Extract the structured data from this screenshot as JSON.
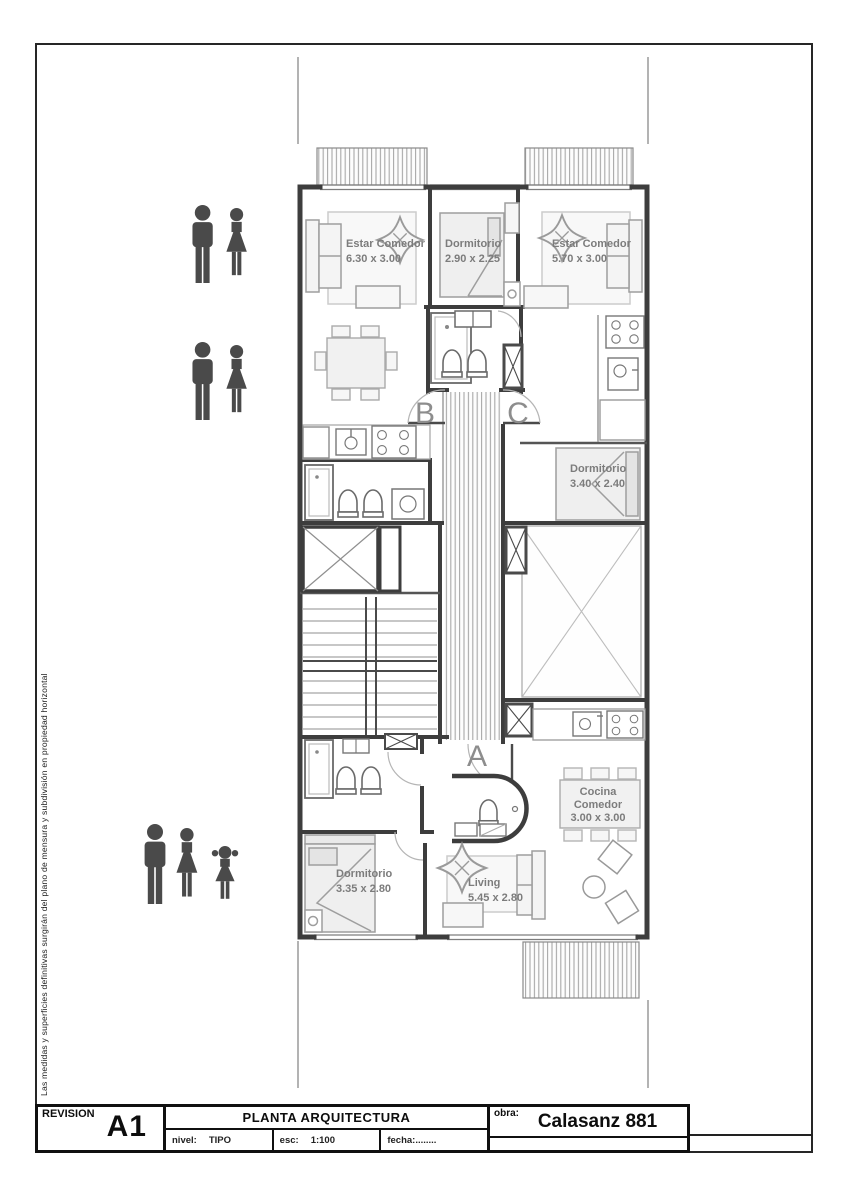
{
  "document": {
    "disclaimer": "Las medidas y superficies definitivas surgirán del plano de mensura y subdivisión en propiedad horizontal"
  },
  "title_block": {
    "revision_label": "REVISION",
    "revision_code": "A1",
    "drawing_title": "PLANTA ARQUITECTURA",
    "nivel_label": "nivel:",
    "nivel_value": "TIPO",
    "escala_label": "esc:",
    "escala_value": "1:100",
    "fecha_label": "fecha:........",
    "obra_label": "obra:",
    "obra_value": "Calasanz 881"
  },
  "plan": {
    "unit_labels": {
      "a": "A",
      "b": "B",
      "c": "C"
    },
    "rooms": {
      "estar_comedor_b": {
        "label": "Estar Comedor",
        "dim": "6.30 x 3.00"
      },
      "dormitorio_b": {
        "label": "Dormitorio",
        "dim": "2.90 x 2.25"
      },
      "estar_comedor_c": {
        "label": "Estar Comedor",
        "dim": "5.70 x 3.00"
      },
      "dormitorio_c": {
        "label": "Dormitorio",
        "dim": "3.40 x 2.40"
      },
      "cocina_comedor_a": {
        "label1": "Cocina",
        "label2": "Comedor",
        "dim": "3.00 x 3.00"
      },
      "dormitorio_a": {
        "label": "Dormitorio",
        "dim": "3.35 x 2.80"
      },
      "living_a": {
        "label": "Living",
        "dim": "5.45 x 2.80"
      }
    }
  },
  "colors": {
    "wall": "#3d3d3d",
    "furniture_stroke": "#9e9e9e",
    "room_label": "#7c7c7c",
    "person_icon": "#4a4a4a",
    "frame": "#262626"
  }
}
